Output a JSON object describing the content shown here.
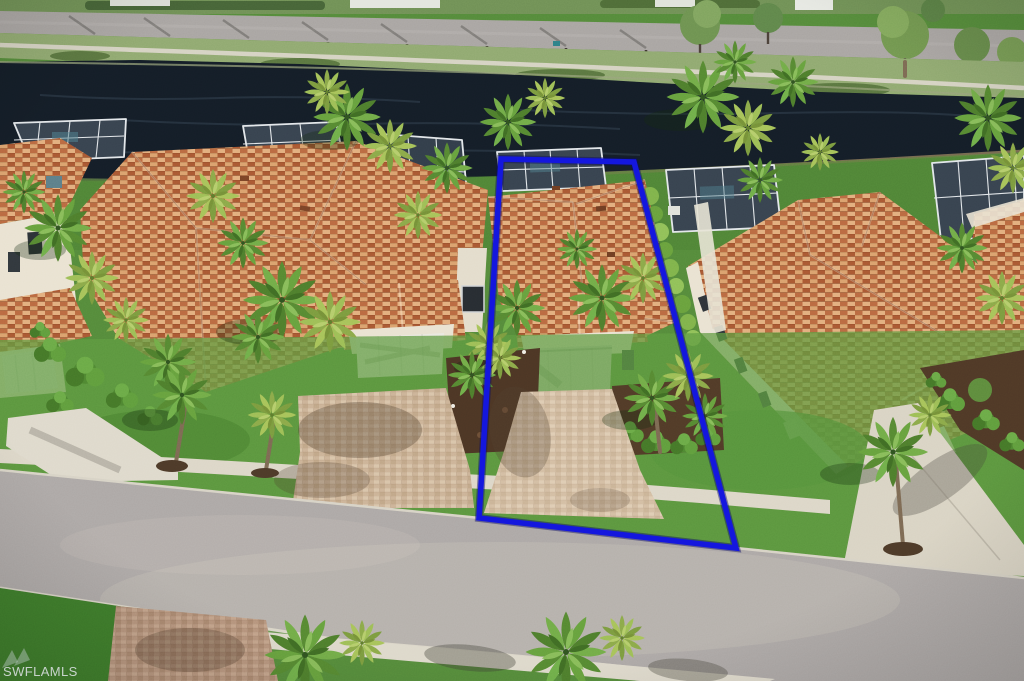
{
  "photo": {
    "kind": "aerial drone real-estate photograph",
    "highlight": "blue property-boundary outline around the center home"
  },
  "watermark": {
    "text": "SWFLAMLS"
  },
  "boundary": {
    "points": "501,159 634,162 736,548 479,518",
    "color": "#1417de",
    "halo_color": "#0a0a66"
  },
  "colors": {
    "water": "#141d27",
    "street": "#aca7a5",
    "lawn": "#54893a",
    "lawn_bright": "#5d9a40",
    "verge": "#8fa86f",
    "roof_base": "#c5764a",
    "paver": "#cbb296",
    "paver_red": "#b5937b",
    "concrete": "#dcd6c7",
    "wall": "#e9e2d1",
    "mulch": "#4b3524",
    "screen_enclosure": "#37424e",
    "enclosure_frame": "#e2e6e9",
    "hedge": "#7eb24a",
    "garage_door_subject": "#d3d0c7",
    "garage_door_white": "#eae8e0"
  }
}
